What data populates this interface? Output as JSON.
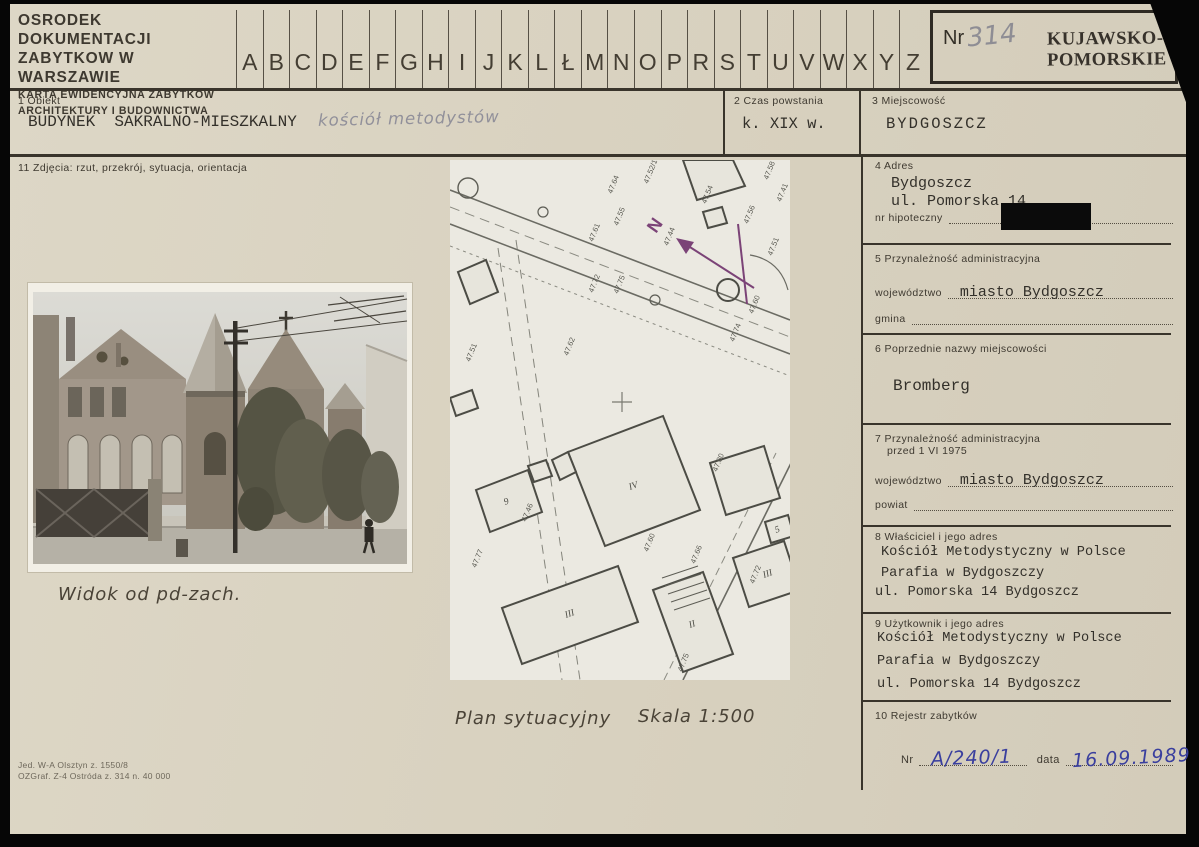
{
  "colors": {
    "card_paper": "#d8d1bf",
    "print_ink": "#39342b",
    "typewriter_ink": "#33302a",
    "pencil": "#8e8d94",
    "blue_ink": "#3a3f9e",
    "stamp_ink": "#37322b"
  },
  "header": {
    "org_line1": "OSRODEK DOKUMENTACJI",
    "org_line2": "ZABYTKOW W WARSZAWIE",
    "card_line1": "KARTA EWIDENCYJNA ZABYTKÓW",
    "card_line2": "ARCHITEKTURY I BUDOWNICTWA",
    "alphabet": [
      "A",
      "B",
      "C",
      "D",
      "E",
      "F",
      "G",
      "H",
      "I",
      "J",
      "K",
      "L",
      "Ł",
      "M",
      "N",
      "O",
      "P",
      "R",
      "S",
      "T",
      "U",
      "V",
      "W",
      "X",
      "Y",
      "Z"
    ],
    "nr_label": "Nr",
    "nr_value": "314",
    "stamp_line1": "KUJAWSKO-",
    "stamp_line2": "POMORSKIE"
  },
  "fields": {
    "f1": {
      "label": "1  Obiekt",
      "typed": "BUDYNEK  SAKRALNO-MIESZKALNY",
      "handwritten": "kościół metodystów"
    },
    "f2": {
      "label": "2  Czas powstania",
      "typed": "k. XIX w."
    },
    "f3": {
      "label": "3  Miejscowość",
      "typed": "BYDGOSZCZ"
    },
    "f11": {
      "label": "11  Zdjęcia: rzut, przekrój, sytuacja, orientacja"
    },
    "f4": {
      "label": "4  Adres",
      "line1": "Bydgoszcz",
      "line2": "ul. Pomorska 14",
      "sub_label": "nr hipoteczny",
      "sub_value_redacted": true
    },
    "f5": {
      "label": "5  Przynależność administracyjna",
      "row1_label": "województwo",
      "row1_value": "miasto Bydgoszcz",
      "row2_label": "gmina",
      "row2_value": ""
    },
    "f6": {
      "label": "6  Poprzednie nazwy miejscowości",
      "typed": "Bromberg"
    },
    "f7": {
      "label_line1": "7  Przynależność administracyjna",
      "label_line2": "przed 1 VI 1975",
      "row1_label": "województwo",
      "row1_value": "miasto Bydgoszcz",
      "row2_label": "powiat",
      "row2_value": ""
    },
    "f8": {
      "label": "8  Właściciel i jego adres",
      "line1": "Kościół Metodystyczny w Polsce",
      "line2": "Parafia w Bydgoszczy",
      "line3": "ul. Pomorska 14 Bydgoszcz"
    },
    "f9": {
      "label": "9  Użytkownik i jego adres",
      "line1": "Kościół Metodystyczny w Polsce",
      "line2": "Parafia w Bydgoszczy",
      "line3": "ul. Pomorska 14 Bydgoszcz"
    },
    "f10": {
      "label": "10  Rejestr zabytków",
      "nr_label": "Nr",
      "nr_value": "A/240/1",
      "date_label": "data",
      "date_value": "16.09.1989"
    }
  },
  "photo": {
    "caption": "Widok od pd-zach."
  },
  "plan": {
    "caption_title": "Plan sytuacyjny",
    "caption_scale": "Skala 1:500",
    "north_label": "N",
    "spot_labels": [
      {
        "t": "47.64",
        "x": 162,
        "y": 34
      },
      {
        "t": "47.55",
        "x": 168,
        "y": 66
      },
      {
        "t": "47.52/14",
        "x": 198,
        "y": 24
      },
      {
        "t": "47.61",
        "x": 143,
        "y": 82
      },
      {
        "t": "47.44",
        "x": 218,
        "y": 86
      },
      {
        "t": "47.54",
        "x": 256,
        "y": 44
      },
      {
        "t": "47.56",
        "x": 298,
        "y": 64
      },
      {
        "t": "47.58",
        "x": 318,
        "y": 20
      },
      {
        "t": "47.41",
        "x": 331,
        "y": 42
      },
      {
        "t": "47.51",
        "x": 322,
        "y": 96
      },
      {
        "t": "47.72",
        "x": 143,
        "y": 133
      },
      {
        "t": "47.75",
        "x": 168,
        "y": 134
      },
      {
        "t": "47.60",
        "x": 303,
        "y": 154
      },
      {
        "t": "47.62",
        "x": 118,
        "y": 196
      },
      {
        "t": "47.51",
        "x": 20,
        "y": 202
      },
      {
        "t": "47.74",
        "x": 284,
        "y": 182
      },
      {
        "t": "47.46",
        "x": 76,
        "y": 362
      },
      {
        "t": "47.60",
        "x": 198,
        "y": 392
      },
      {
        "t": "47.66",
        "x": 245,
        "y": 404
      },
      {
        "t": "47.80",
        "x": 267,
        "y": 312
      },
      {
        "t": "47.72",
        "x": 304,
        "y": 424
      },
      {
        "t": "47.77",
        "x": 26,
        "y": 408
      },
      {
        "t": "47.75",
        "x": 232,
        "y": 512
      }
    ],
    "building_labels": [
      {
        "t": "IV",
        "x": 180,
        "y": 330
      },
      {
        "t": "II",
        "x": 240,
        "y": 468
      },
      {
        "t": "III",
        "x": 116,
        "y": 458
      },
      {
        "t": "III",
        "x": 314,
        "y": 418
      },
      {
        "t": "9",
        "x": 55,
        "y": 345
      },
      {
        "t": "5",
        "x": 326,
        "y": 373
      }
    ]
  },
  "imprint": {
    "line1": "Jed. W-A Olsztyn z. 1550/8",
    "line2": "OZGraf. Z-4 Ostróda z. 314 n. 40 000"
  }
}
